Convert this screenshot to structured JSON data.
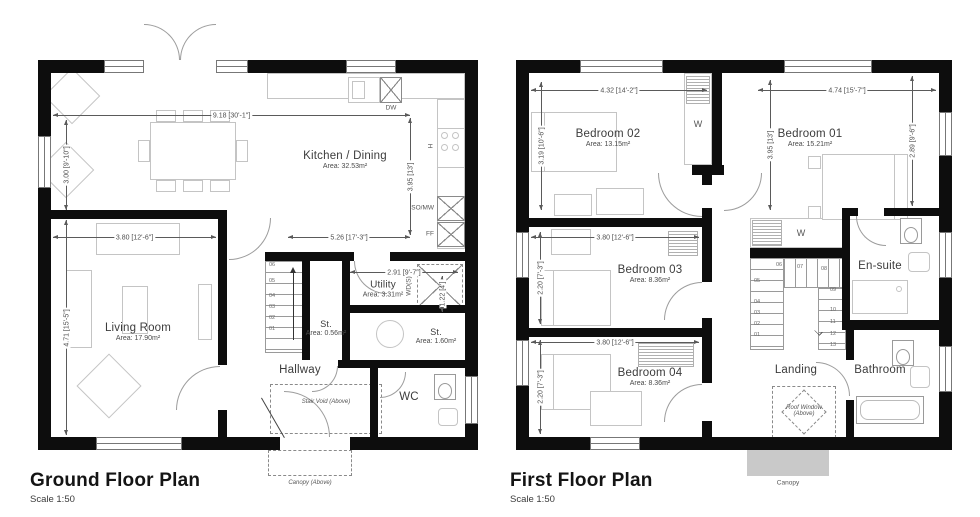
{
  "ground_floor": {
    "title": "Ground Floor Plan",
    "scale": "Scale 1:50",
    "rooms": {
      "kitchen_dining": {
        "name": "Kitchen / Dining",
        "area": "Area: 32.53m²"
      },
      "living_room": {
        "name": "Living Room",
        "area": "Area: 17.90m²"
      },
      "utility": {
        "name": "Utility",
        "area": "Area: 3.31m²"
      },
      "store_1": {
        "name": "St.",
        "area": "Area: 0.56m²"
      },
      "store_2": {
        "name": "St.",
        "area": "Area: 1.60m²"
      },
      "hallway": {
        "name": "Hallway"
      },
      "wc": {
        "name": "WC"
      }
    },
    "dimensions": {
      "overall_width": "9.18 [30'-1\"]",
      "dining_depth": "3.00 [9'-10\"]",
      "living_depth": "4.71 [15'-5\"]",
      "living_width": "3.80 [12'-6\"]",
      "kitchen_width": "5.26 [17'-3\"]",
      "kitchen_depth": "3.95 [13']",
      "utility_width": "2.91 [9'-7\"]",
      "store_width": "1.22 [4']"
    },
    "appliances": {
      "dishwasher": "DW",
      "hob": "H",
      "oven_microwave": "SO/MW",
      "fridge_freezer": "FF",
      "washer_dryer": "WD(S)"
    },
    "annotations": {
      "stair_void": "Stair Void (Above)",
      "canopy": "Canopy (Above)"
    },
    "stair_numbers": [
      "01",
      "02",
      "03",
      "04",
      "05",
      "06"
    ]
  },
  "first_floor": {
    "title": "First Floor Plan",
    "scale": "Scale 1:50",
    "rooms": {
      "bedroom_01": {
        "name": "Bedroom 01",
        "area": "Area: 15.21m²"
      },
      "bedroom_02": {
        "name": "Bedroom 02",
        "area": "Area: 13.15m²"
      },
      "bedroom_03": {
        "name": "Bedroom 03",
        "area": "Area: 8.36m²"
      },
      "bedroom_04": {
        "name": "Bedroom 04",
        "area": "Area: 8.36m²"
      },
      "en_suite": {
        "name": "En-suite"
      },
      "bathroom": {
        "name": "Bathroom"
      },
      "landing": {
        "name": "Landing"
      }
    },
    "dimensions": {
      "bedroom_02_width": "4.32 [14'-2\"]",
      "bedroom_01_width": "4.74 [15'-7\"]",
      "bedroom_02_depth": "3.19 [10'-6\"]",
      "bedroom_01_depth": "3.95 [13']",
      "bedroom_01_bed_width": "2.89 [9'-6\"]",
      "bedroom_03_width": "3.80 [12'-6\"]",
      "bedroom_03_depth": "2.20 [7'-3\"]",
      "bedroom_04_width": "3.80 [12'-6\"]",
      "bedroom_04_depth": "2.20 [7'-3\"]"
    },
    "labels": {
      "wardrobe_1": "W",
      "wardrobe_2": "W"
    },
    "annotations": {
      "roof_window": "Roof Window (Above)",
      "canopy": "Canopy"
    },
    "stair_numbers": [
      "01",
      "02",
      "03",
      "04",
      "05",
      "06",
      "07",
      "08",
      "09",
      "10",
      "11",
      "12",
      "13"
    ]
  },
  "colors": {
    "wall": "#0d0d0d",
    "furniture_outline": "#c4c4c4",
    "dimension_text": "#4f4f4f",
    "canopy_fill": "#c9c9c9"
  }
}
